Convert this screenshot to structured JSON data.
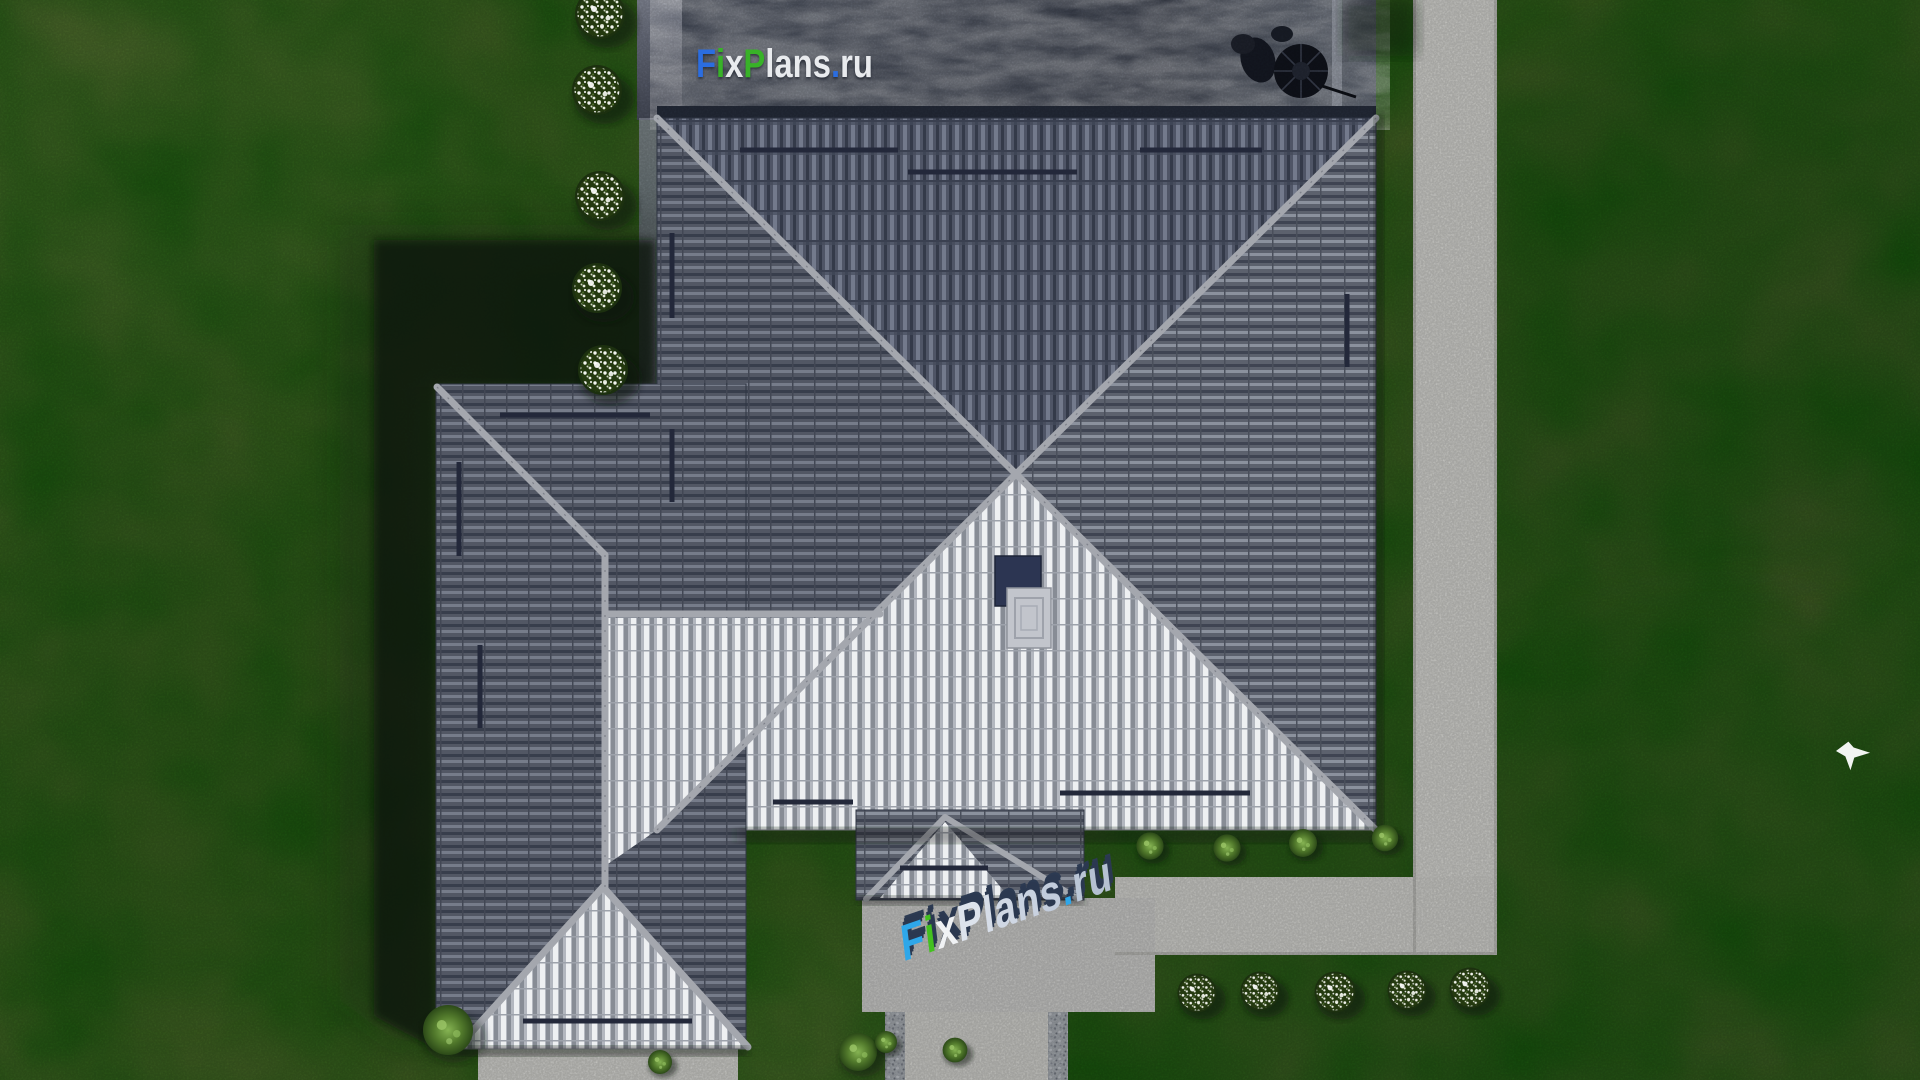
{
  "watermarks": {
    "site_top": "FixPlans.ru",
    "site_path": "FixPlans.ru"
  },
  "letters_top": [
    {
      "ch": "F",
      "color": "#2b6de0"
    },
    {
      "ch": "i",
      "color": "#38b228"
    },
    {
      "ch": "x",
      "color": "#e9ebee"
    },
    {
      "ch": "P",
      "color": "#38b228"
    },
    {
      "ch": "l",
      "color": "#e9ebee"
    },
    {
      "ch": "a",
      "color": "#e9ebee"
    },
    {
      "ch": "n",
      "color": "#e9ebee"
    },
    {
      "ch": "s",
      "color": "#e9ebee"
    },
    {
      "ch": ".",
      "color": "#2b6de0"
    },
    {
      "ch": "r",
      "color": "#e9ebee"
    },
    {
      "ch": "u",
      "color": "#e9ebee"
    }
  ],
  "letters_path": [
    {
      "ch": "F",
      "color": "#2ea7ea"
    },
    {
      "ch": "i",
      "color": "#43c01f"
    },
    {
      "ch": "x",
      "color": "#f0f2f4"
    },
    {
      "ch": "P",
      "color": "#dde3ec"
    },
    {
      "ch": "l",
      "color": "#d6dde8"
    },
    {
      "ch": "a",
      "color": "#cfd7e4"
    },
    {
      "ch": "n",
      "color": "#c9d2e0"
    },
    {
      "ch": "s",
      "color": "#c2ccdc"
    },
    {
      "ch": ".",
      "color": "#2ea7ea"
    },
    {
      "ch": "r",
      "color": "#bbc6d6"
    },
    {
      "ch": "u",
      "color": "#b5c1d2"
    }
  ],
  "palette": {
    "grass_base": "#5a6b33",
    "grass_dark": "#47592a",
    "grass_light": "#6a7b3e",
    "path_concrete": "#d5d5d1",
    "patio_marble": "#353c4b",
    "roof_north": "#4f5566",
    "roof_bright": "#b3b7bf",
    "roof_side": "#5c616d",
    "ridge_cap": "#a4a7ae",
    "chimney_navy": "#2c3552",
    "bush_green": "#6f9c42",
    "flower_white": "#f2f4ee",
    "shadow": "#0b130b",
    "bird_white": "#f2f4f2"
  }
}
